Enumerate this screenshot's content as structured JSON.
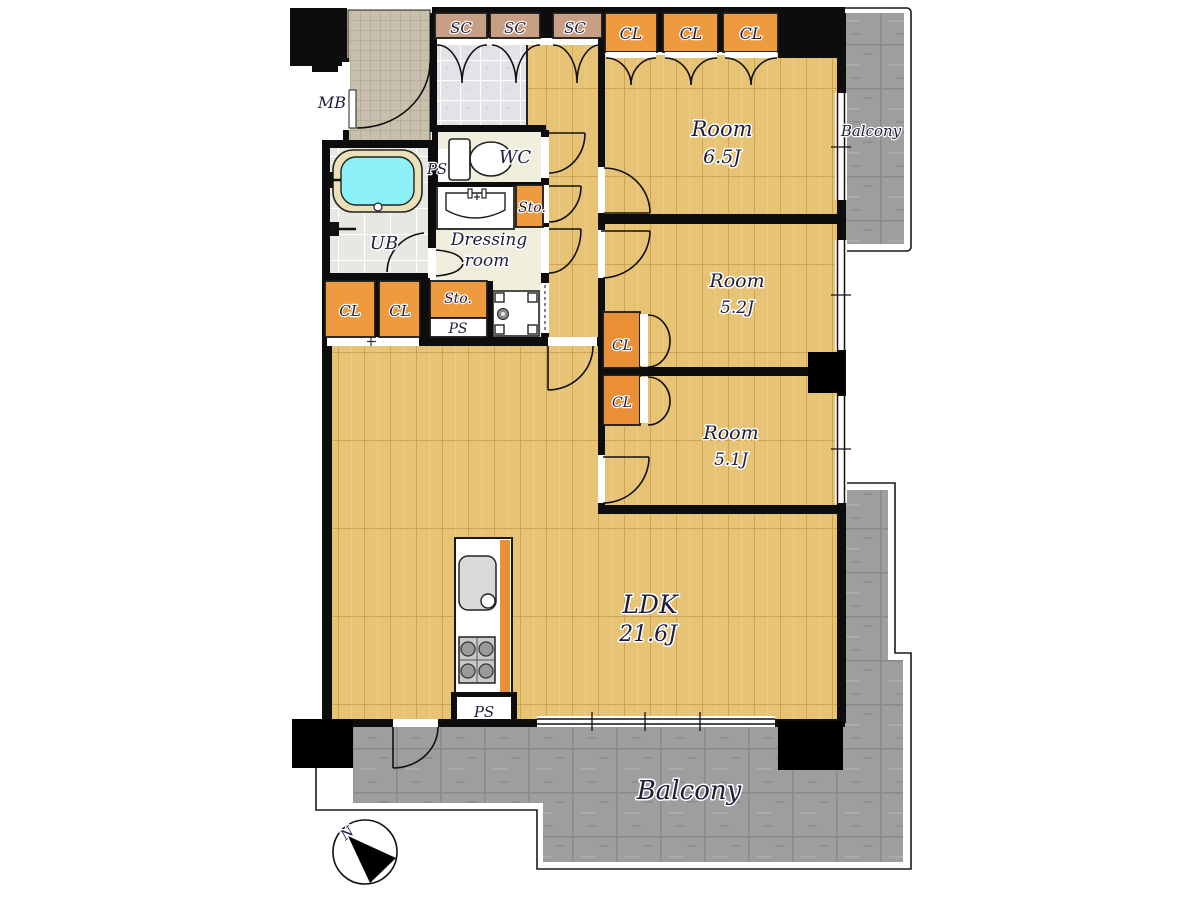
{
  "labels": {
    "mb": "MB",
    "sc": "SC",
    "cl": "CL",
    "wc": "WC",
    "ub": "UB",
    "sto": "Sto.",
    "ps": "PS",
    "dressing_line1": "Dressing",
    "dressing_line2": "room",
    "balcony": "Balcony",
    "north": "N"
  },
  "rooms": {
    "room_6_5": {
      "name": "Room",
      "size": "6.5J"
    },
    "room_5_2": {
      "name": "Room",
      "size": "5.2J"
    },
    "room_5_1": {
      "name": "Room",
      "size": "5.1J"
    },
    "ldk": {
      "name": "LDK",
      "size": "21.6J"
    }
  },
  "colors": {
    "wood_floor": "#e7c376",
    "closet_orange": "#ee9b3f",
    "shoe_closet_tan": "#c89f85",
    "balcony_gray": "#9e9e9e",
    "wall_black": "#0d0d0d",
    "bath_water_cyan": "#8df1f7",
    "sheet_floor_cream": "#f0eedd",
    "label_ink": "#1e1e3c"
  }
}
